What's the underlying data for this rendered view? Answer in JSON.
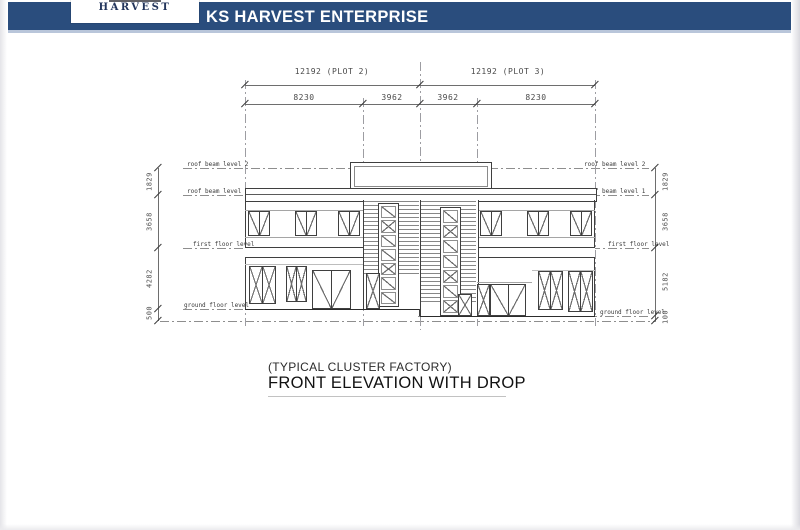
{
  "header": {
    "logo_text": "HARVEST",
    "title": "KS HARVEST ENTERPRISE"
  },
  "dimensions": {
    "plot_left": "12192 (PLOT 2)",
    "plot_right": "12192 (PLOT 3)",
    "top_segments": [
      "8230",
      "3962",
      "3962",
      "8230"
    ],
    "left_vertical": [
      "1829",
      "3658",
      "4282",
      "500"
    ],
    "right_vertical": [
      "1829",
      "3658",
      "5182",
      "100"
    ]
  },
  "levels": {
    "roof_beam_2": "roof beam level 2",
    "roof_beam_1": "roof beam level 1",
    "first_floor": "first floor level",
    "ground_floor": "ground floor level"
  },
  "captions": {
    "type_label": "(TYPICAL CLUSTER FACTORY)",
    "drawing_title": "FRONT ELEVATION WITH DROP"
  },
  "colors": {
    "header_blue": "#2a4d7d",
    "header_underline": "#b9c6da",
    "drawing_line": "#3f3f3f"
  }
}
